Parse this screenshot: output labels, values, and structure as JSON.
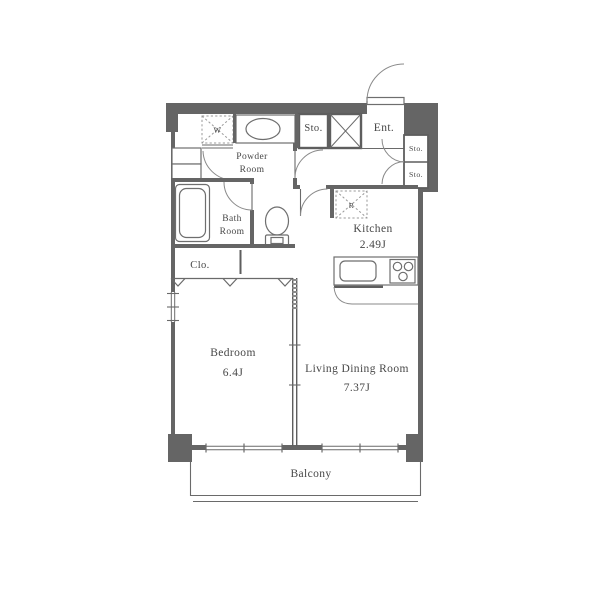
{
  "plan": {
    "rooms": {
      "powder_room": {
        "line1": "Powder",
        "line2": "Room"
      },
      "bath_room": {
        "line1": "Bath",
        "line2": "Room"
      },
      "storage_top": {
        "label": "Sto."
      },
      "entrance": {
        "label": "Ent."
      },
      "storage_right_1": {
        "label": "Sto."
      },
      "storage_right_2": {
        "label": "Sto."
      },
      "kitchen": {
        "name": "Kitchen",
        "size": "2.49J"
      },
      "closet": {
        "label": "Clo."
      },
      "bedroom": {
        "name": "Bedroom",
        "size": "6.4J"
      },
      "living_dining": {
        "name": "Living Dining Room",
        "size": "7.37J"
      },
      "balcony": {
        "label": "Balcony"
      },
      "washer_space": {
        "label": "W"
      },
      "refrigerator_space": {
        "label": "R"
      }
    },
    "colors": {
      "wall": "#656565",
      "line": "#6a6a6a",
      "text": "#474747",
      "background": "#ffffff"
    }
  }
}
